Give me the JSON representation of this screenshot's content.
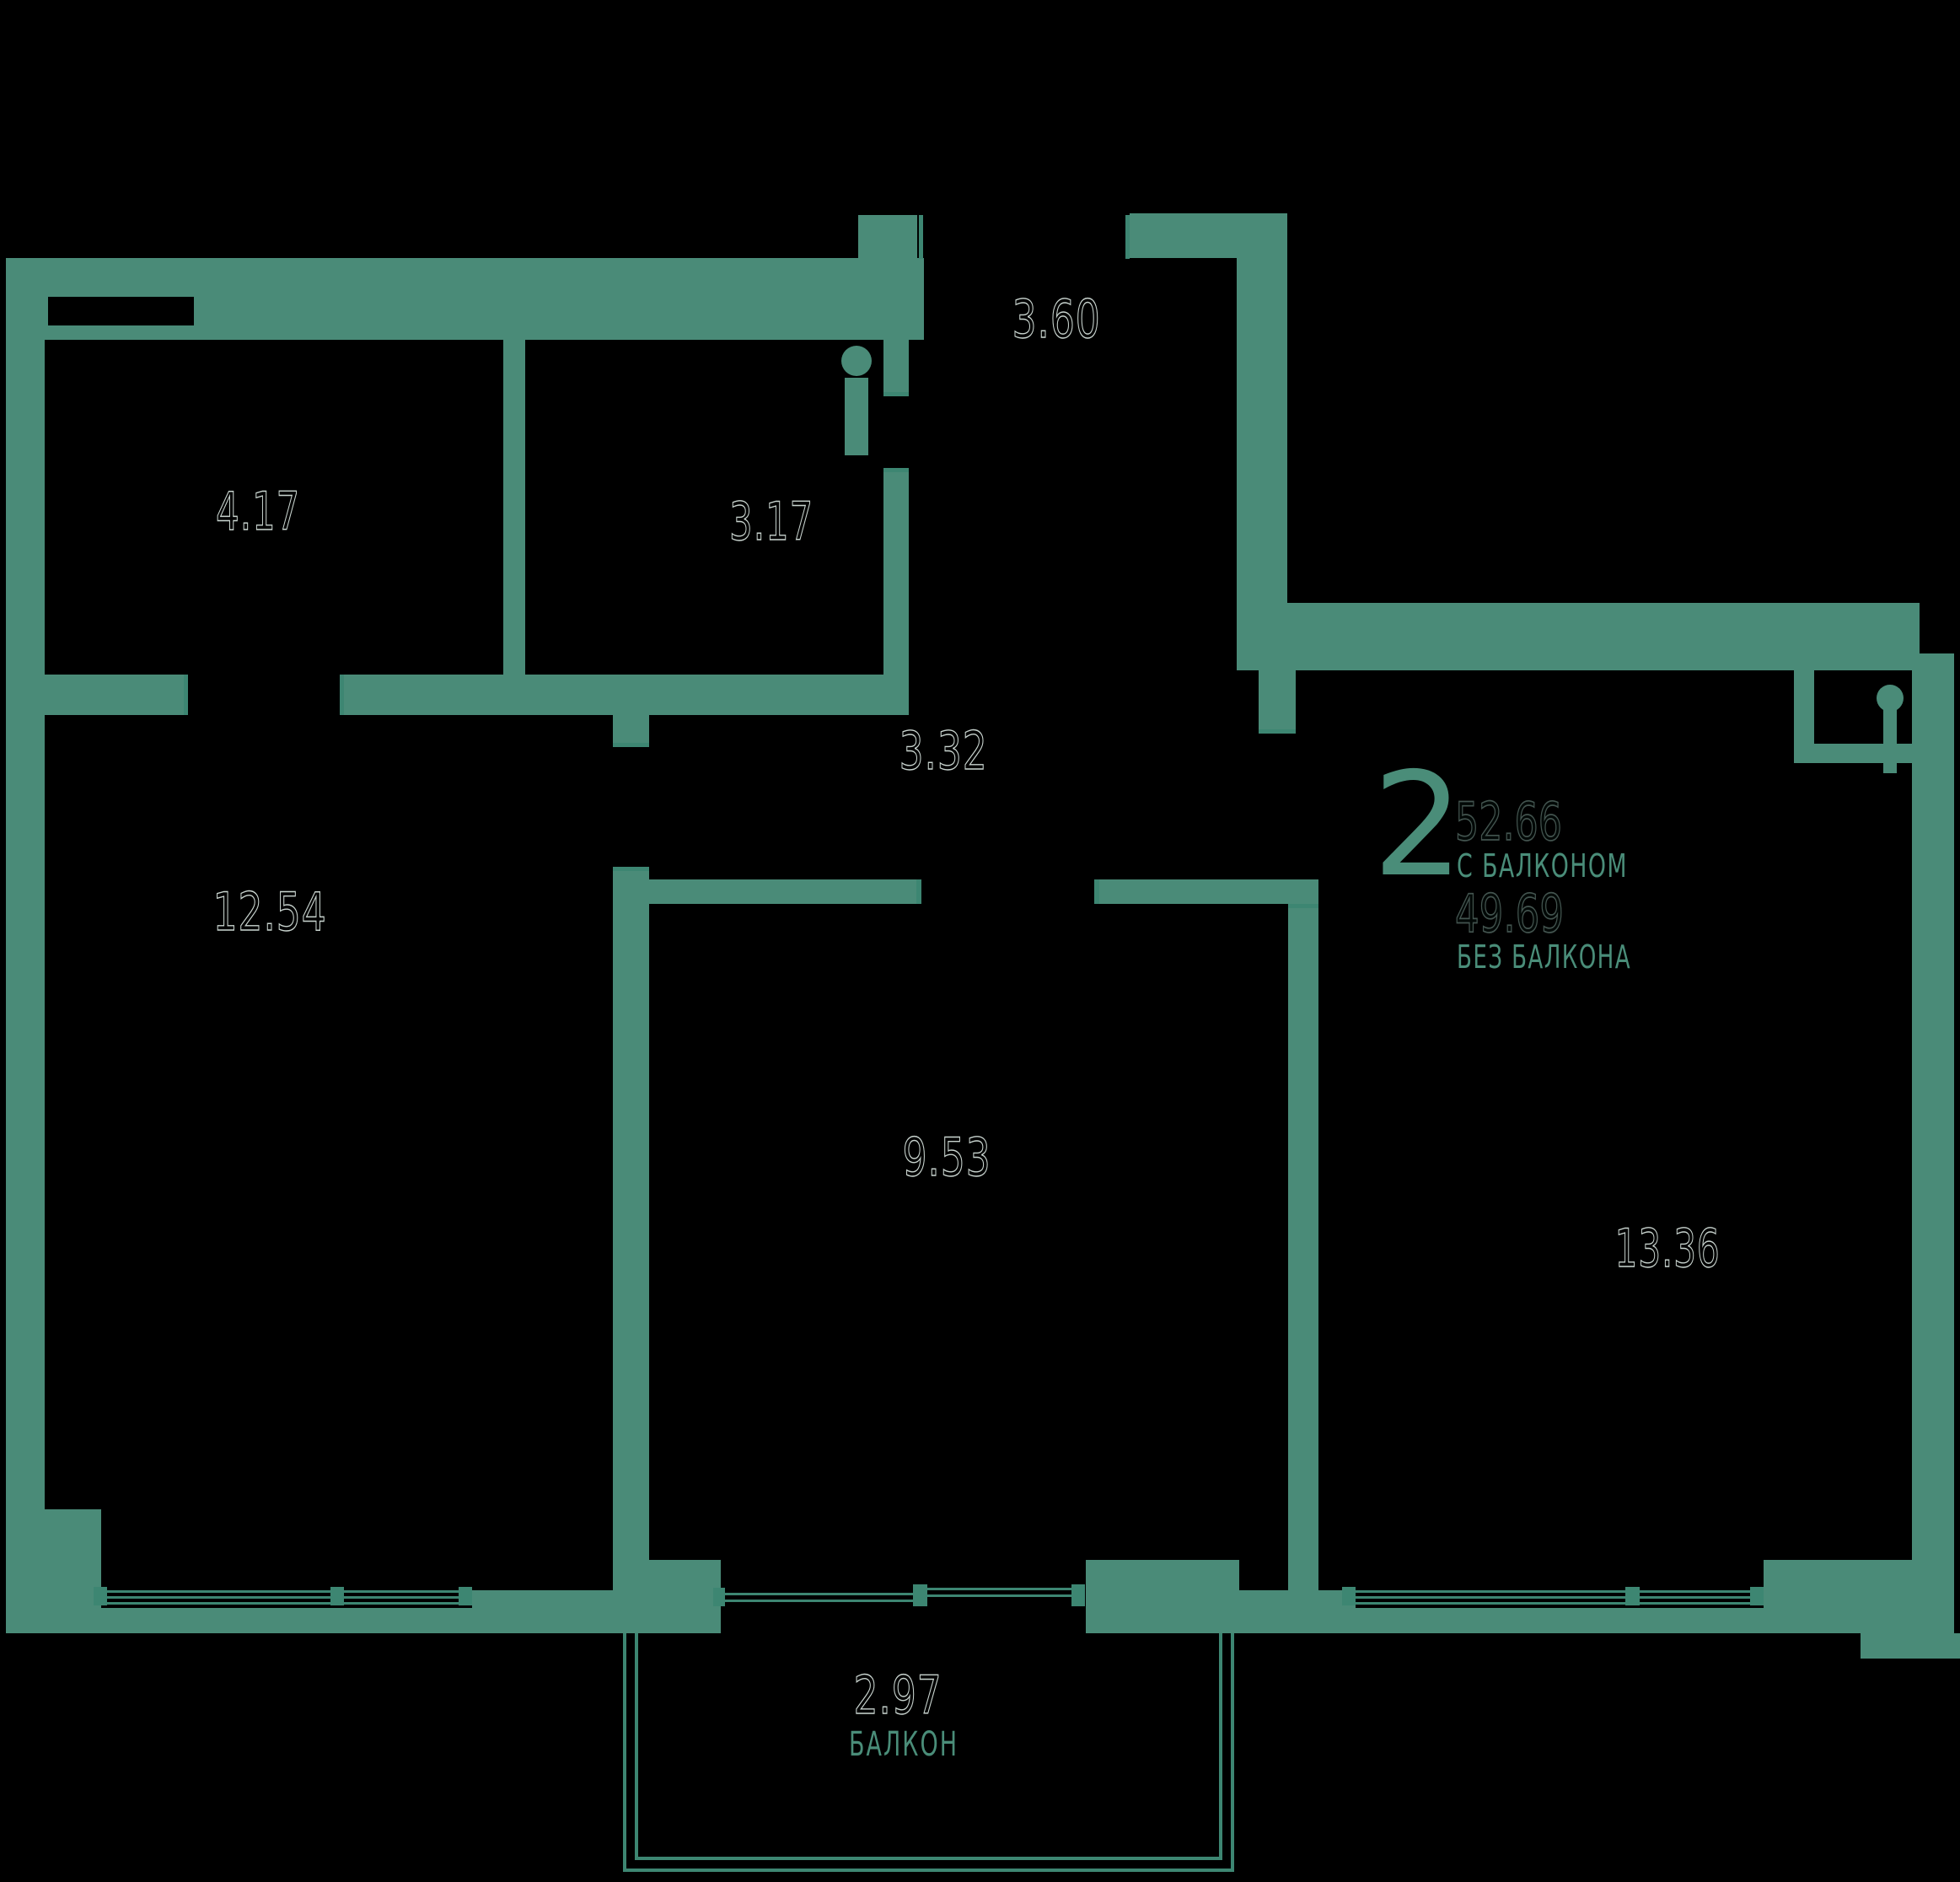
{
  "plan": {
    "type_label": "floor-plan-2-room-apartment",
    "colors": {
      "background": "#000000",
      "wall": "#4a8b78",
      "thin_line": "#3d8672",
      "teal_text": "#4a8d79",
      "room_number_outline": "#c9d4cf"
    },
    "summary": {
      "rooms_count": "2",
      "area_with_balcony": "52.66",
      "with_balcony_label": "С БАЛКОНОМ",
      "area_without_balcony": "49.69",
      "without_balcony_label": "БЕЗ БАЛКОНА"
    },
    "rooms": [
      {
        "name": "storage-room",
        "area": "4.17"
      },
      {
        "name": "bathroom",
        "area": "3.17"
      },
      {
        "name": "entry-hall",
        "area": "3.60"
      },
      {
        "name": "corridor",
        "area": "3.32"
      },
      {
        "name": "living-room",
        "area": "12.54"
      },
      {
        "name": "kitchen",
        "area": "9.53"
      },
      {
        "name": "bedroom",
        "area": "13.36"
      }
    ],
    "balcony": {
      "area": "2.97",
      "label": "БАЛКОН"
    }
  }
}
